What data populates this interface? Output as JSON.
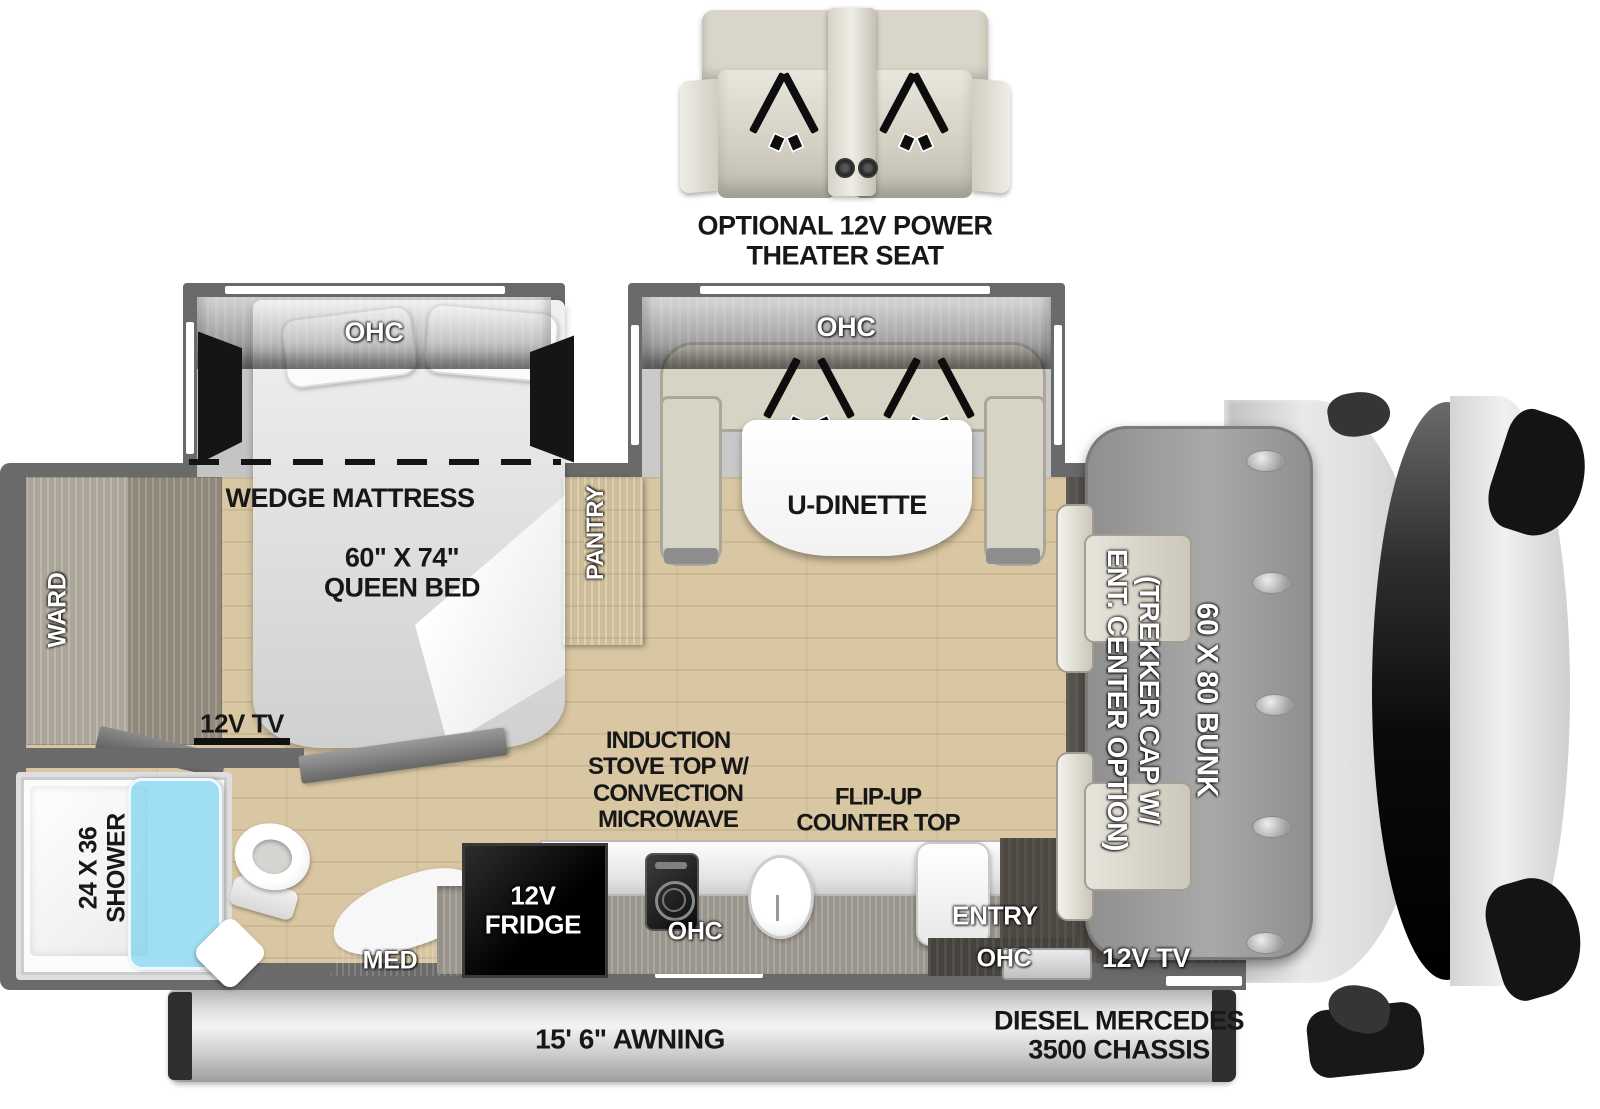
{
  "theater_seat": {
    "label": "OPTIONAL 12V POWER\nTHEATER SEAT"
  },
  "bedroom": {
    "ohc_label": "OHC",
    "wedge_label": "WEDGE MATTRESS",
    "bed_label": "60\" X 74\"\nQUEEN BED",
    "tv_label": "12V TV",
    "ward_label": "WARD",
    "pantry_label": "PANTRY"
  },
  "dinette": {
    "ohc_label": "OHC",
    "table_label": "U-DINETTE"
  },
  "bathroom": {
    "shower_label": "24 X 36\nSHOWER",
    "med_label": "MED"
  },
  "kitchen": {
    "fridge_label": "12V\nFRIDGE",
    "stove_label": "INDUCTION\nSTOVE TOP W/\nCONVECTION\nMICROWAVE",
    "flipup_label": "FLIP-UP\nCOUNTER TOP",
    "ohc_label": "OHC"
  },
  "entry": {
    "entry_label": "ENTRY",
    "ohc_label": "OHC"
  },
  "cab": {
    "cap_label": "(TREKKER CAP W/\nENT. CENTER OPTION)",
    "bunk_label": "60 X 80 BUNK",
    "tv_label": "12V TV"
  },
  "exterior": {
    "awning_label": "15' 6\" AWNING",
    "chassis_label": "DIESEL MERCEDES\n3500 CHASSIS"
  },
  "colors": {
    "wall": "#6a6a6a",
    "floor_wood": "#d9c7a3",
    "slideout_floor": "#c6c6c6",
    "shower_glass": "#7dd4f0",
    "bunk": "#9c9c9c",
    "seat_beige": "#d7d3c5",
    "label_black": "#171717"
  }
}
